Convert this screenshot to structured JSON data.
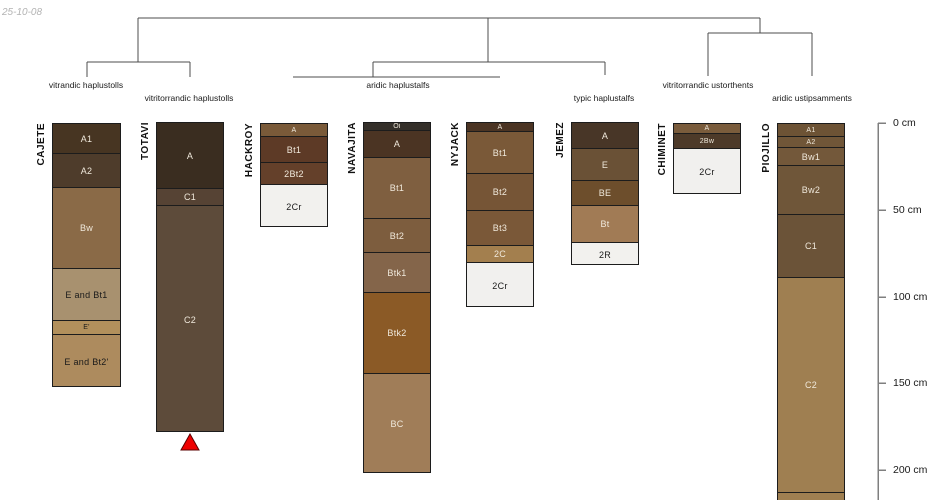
{
  "meta": {
    "date_label": "25-10-08"
  },
  "palette": {
    "background": "#ffffff",
    "tree_line": "#4c4c4c",
    "axis_line": "#7f7f7f",
    "column_border": "#1c1c1c",
    "label_light": "#f0e9dc",
    "label_dark": "#1a1a1a",
    "marker_fill": "#ee0000",
    "marker_stroke": "#5a0000"
  },
  "dendrogram": {
    "segments": [
      [
        138,
        18,
        760,
        18
      ],
      [
        138,
        18,
        138,
        62
      ],
      [
        87,
        62,
        190,
        62
      ],
      [
        87,
        62,
        87,
        77
      ],
      [
        190,
        62,
        190,
        77
      ],
      [
        488,
        18,
        488,
        62
      ],
      [
        373,
        62,
        605,
        62
      ],
      [
        373,
        62,
        373,
        77
      ],
      [
        293,
        77,
        500,
        77
      ],
      [
        605,
        62,
        605,
        75
      ],
      [
        760,
        18,
        760,
        33
      ],
      [
        708,
        33,
        812,
        33
      ],
      [
        708,
        33,
        708,
        76
      ],
      [
        812,
        33,
        812,
        76
      ]
    ],
    "labels": [
      {
        "text": "vitrandic haplustolls",
        "cx": 86,
        "top": 80
      },
      {
        "text": "vitritorrandic haplustolls",
        "cx": 189,
        "top": 93
      },
      {
        "text": "aridic haplustalfs",
        "cx": 398,
        "top": 80
      },
      {
        "text": "typic haplustalfs",
        "cx": 604,
        "top": 93
      },
      {
        "text": "vitritorrandic ustorthents",
        "cx": 708,
        "top": 80
      },
      {
        "text": "aridic ustipsamments",
        "cx": 812,
        "top": 93
      }
    ]
  },
  "depth_axis": {
    "x": 878,
    "y_top": 123,
    "y_bottom": 500,
    "tick_len": 8,
    "ticks": [
      {
        "label": "0 cm",
        "y": 123
      },
      {
        "label": "50 cm",
        "y": 210
      },
      {
        "label": "100 cm",
        "y": 297
      },
      {
        "label": "150 cm",
        "y": 383
      },
      {
        "label": "200 cm",
        "y": 470
      }
    ]
  },
  "profiles": [
    {
      "name": "CAJETE",
      "x": 52,
      "width": 69,
      "top": 123,
      "horizons": [
        {
          "label": "A1",
          "from": 123,
          "to": 153,
          "color": "#473522",
          "tone": "light"
        },
        {
          "label": "A2",
          "from": 153,
          "to": 187,
          "color": "#4e3c2b",
          "tone": "light"
        },
        {
          "label": "Bw",
          "from": 187,
          "to": 268,
          "color": "#8a6a47",
          "tone": "light"
        },
        {
          "label": "E and Bt1",
          "from": 268,
          "to": 320,
          "color": "#a8916f",
          "tone": "dark"
        },
        {
          "label": "E'",
          "from": 320,
          "to": 334,
          "color": "#b2905c",
          "tone": "dark"
        },
        {
          "label": "E and Bt2'",
          "from": 334,
          "to": 387,
          "color": "#ad8b5e",
          "tone": "dark"
        }
      ]
    },
    {
      "name": "TOTAVI",
      "x": 156,
      "width": 68,
      "top": 122,
      "horizons": [
        {
          "label": "A",
          "from": 122,
          "to": 188,
          "color": "#3a2d20",
          "tone": "light"
        },
        {
          "label": "C1",
          "from": 188,
          "to": 205,
          "color": "#564334",
          "tone": "light"
        },
        {
          "label": "C2",
          "from": 205,
          "to": 432,
          "color": "#5d4b3a",
          "tone": "light"
        }
      ],
      "marker": {
        "cx": 190,
        "apex_y": 434,
        "base_y": 450,
        "half_width": 9
      }
    },
    {
      "name": "HACKROY",
      "x": 260,
      "width": 68,
      "top": 123,
      "horizons": [
        {
          "label": "A",
          "from": 123,
          "to": 136,
          "color": "#7a5a39",
          "tone": "light"
        },
        {
          "label": "Bt1",
          "from": 136,
          "to": 162,
          "color": "#5d3a26",
          "tone": "light"
        },
        {
          "label": "2Bt2",
          "from": 162,
          "to": 184,
          "color": "#64402a",
          "tone": "light"
        },
        {
          "label": "2Cr",
          "from": 184,
          "to": 227,
          "color": "#f2f1ee",
          "tone": "dark"
        }
      ]
    },
    {
      "name": "NAVAJITA",
      "x": 363,
      "width": 68,
      "top": 122,
      "horizons": [
        {
          "label": "Oi",
          "from": 122,
          "to": 130,
          "color": "#35302a",
          "tone": "light"
        },
        {
          "label": "A",
          "from": 130,
          "to": 157,
          "color": "#4b3423",
          "tone": "light"
        },
        {
          "label": "Bt1",
          "from": 157,
          "to": 218,
          "color": "#7f5f40",
          "tone": "light"
        },
        {
          "label": "Bt2",
          "from": 218,
          "to": 252,
          "color": "#7d5d3e",
          "tone": "light"
        },
        {
          "label": "Btk1",
          "from": 252,
          "to": 292,
          "color": "#84654a",
          "tone": "light"
        },
        {
          "label": "Btk2",
          "from": 292,
          "to": 373,
          "color": "#8b5a26",
          "tone": "light"
        },
        {
          "label": "BC",
          "from": 373,
          "to": 473,
          "color": "#a07d58",
          "tone": "light"
        }
      ]
    },
    {
      "name": "NYJACK",
      "x": 466,
      "width": 68,
      "top": 122,
      "horizons": [
        {
          "label": "A",
          "from": 122,
          "to": 131,
          "color": "#4b3423",
          "tone": "light"
        },
        {
          "label": "Bt1",
          "from": 131,
          "to": 173,
          "color": "#7a5938",
          "tone": "light"
        },
        {
          "label": "Bt2",
          "from": 173,
          "to": 210,
          "color": "#765536",
          "tone": "light"
        },
        {
          "label": "Bt3",
          "from": 210,
          "to": 245,
          "color": "#7a5838",
          "tone": "light"
        },
        {
          "label": "2C",
          "from": 245,
          "to": 262,
          "color": "#a37f4e",
          "tone": "light"
        },
        {
          "label": "2Cr",
          "from": 262,
          "to": 307,
          "color": "#f1f0ee",
          "tone": "dark"
        }
      ]
    },
    {
      "name": "JEMEZ",
      "x": 571,
      "width": 68,
      "top": 122,
      "horizons": [
        {
          "label": "A",
          "from": 122,
          "to": 148,
          "color": "#483627",
          "tone": "light"
        },
        {
          "label": "E",
          "from": 148,
          "to": 180,
          "color": "#6a5136",
          "tone": "light"
        },
        {
          "label": "BE",
          "from": 180,
          "to": 205,
          "color": "#6d4e2c",
          "tone": "light"
        },
        {
          "label": "Bt",
          "from": 205,
          "to": 242,
          "color": "#a17b55",
          "tone": "light"
        },
        {
          "label": "2R",
          "from": 242,
          "to": 265,
          "color": "#f2f1ee",
          "tone": "dark"
        }
      ]
    },
    {
      "name": "CHIMINET",
      "x": 673,
      "width": 68,
      "top": 123,
      "horizons": [
        {
          "label": "A",
          "from": 123,
          "to": 133,
          "color": "#7a5c3c",
          "tone": "light"
        },
        {
          "label": "2Bw",
          "from": 133,
          "to": 148,
          "color": "#4d3a29",
          "tone": "light"
        },
        {
          "label": "2Cr",
          "from": 148,
          "to": 194,
          "color": "#f1f0ee",
          "tone": "dark"
        }
      ]
    },
    {
      "name": "PIOJILLO",
      "x": 777,
      "width": 68,
      "top": 123,
      "horizons": [
        {
          "label": "A1",
          "from": 123,
          "to": 136,
          "color": "#6d5335",
          "tone": "light"
        },
        {
          "label": "A2",
          "from": 136,
          "to": 147,
          "color": "#705638",
          "tone": "light"
        },
        {
          "label": "Bw1",
          "from": 147,
          "to": 165,
          "color": "#73583a",
          "tone": "light"
        },
        {
          "label": "Bw2",
          "from": 165,
          "to": 214,
          "color": "#6f5639",
          "tone": "light"
        },
        {
          "label": "C1",
          "from": 214,
          "to": 277,
          "color": "#6b5338",
          "tone": "light"
        },
        {
          "label": "C2",
          "from": 277,
          "to": 492,
          "color": "#9f7f51",
          "tone": "light"
        },
        {
          "label": "",
          "from": 492,
          "to": 502,
          "color": "#9f7f51",
          "tone": "light"
        }
      ]
    }
  ]
}
